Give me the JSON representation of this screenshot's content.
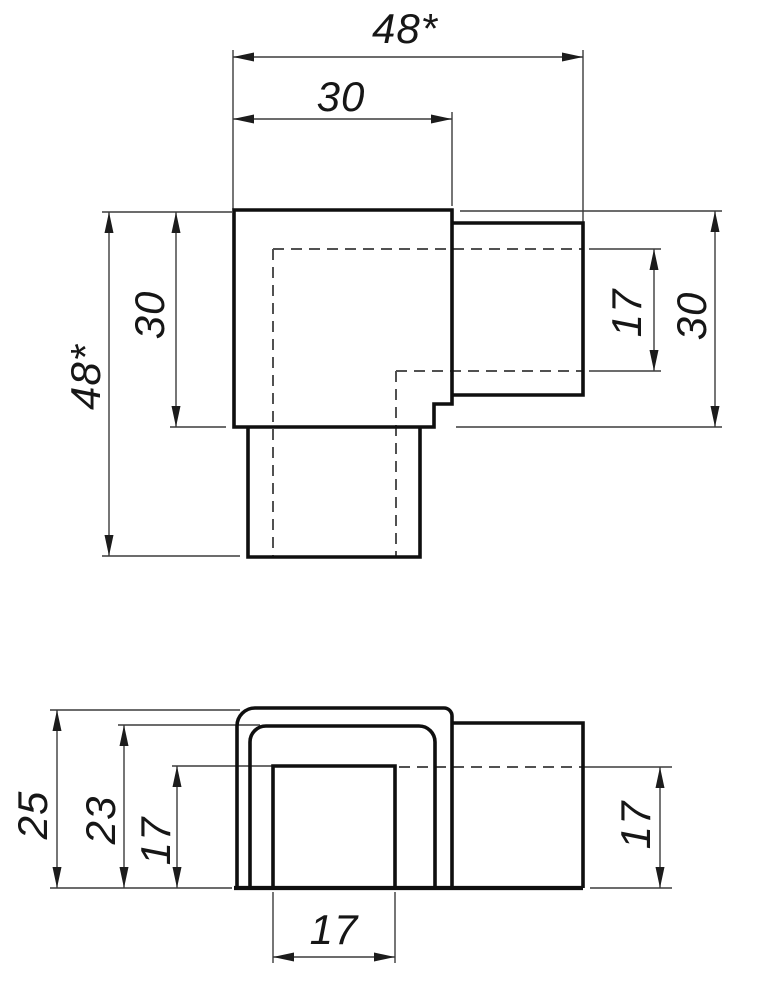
{
  "drawing": {
    "kind": "technical-dimension-drawing",
    "subject": "square-tube corner connector, two orthographic views",
    "colors": {
      "background": "#ffffff",
      "object_line": "#0f0f0f",
      "thin_line": "#3c3c3c",
      "dashed_line": "#515151",
      "text": "#161616"
    }
  },
  "dims": {
    "top": {
      "overall_width": "48*",
      "body_width": "30",
      "overall_height": "48*",
      "body_height": "30",
      "socket_inner": "17",
      "body_height_right": "30"
    },
    "front": {
      "cap_height": "25",
      "inner_height": "23",
      "hole_height": "17",
      "socket_inner": "17",
      "hole_width": "17"
    }
  }
}
